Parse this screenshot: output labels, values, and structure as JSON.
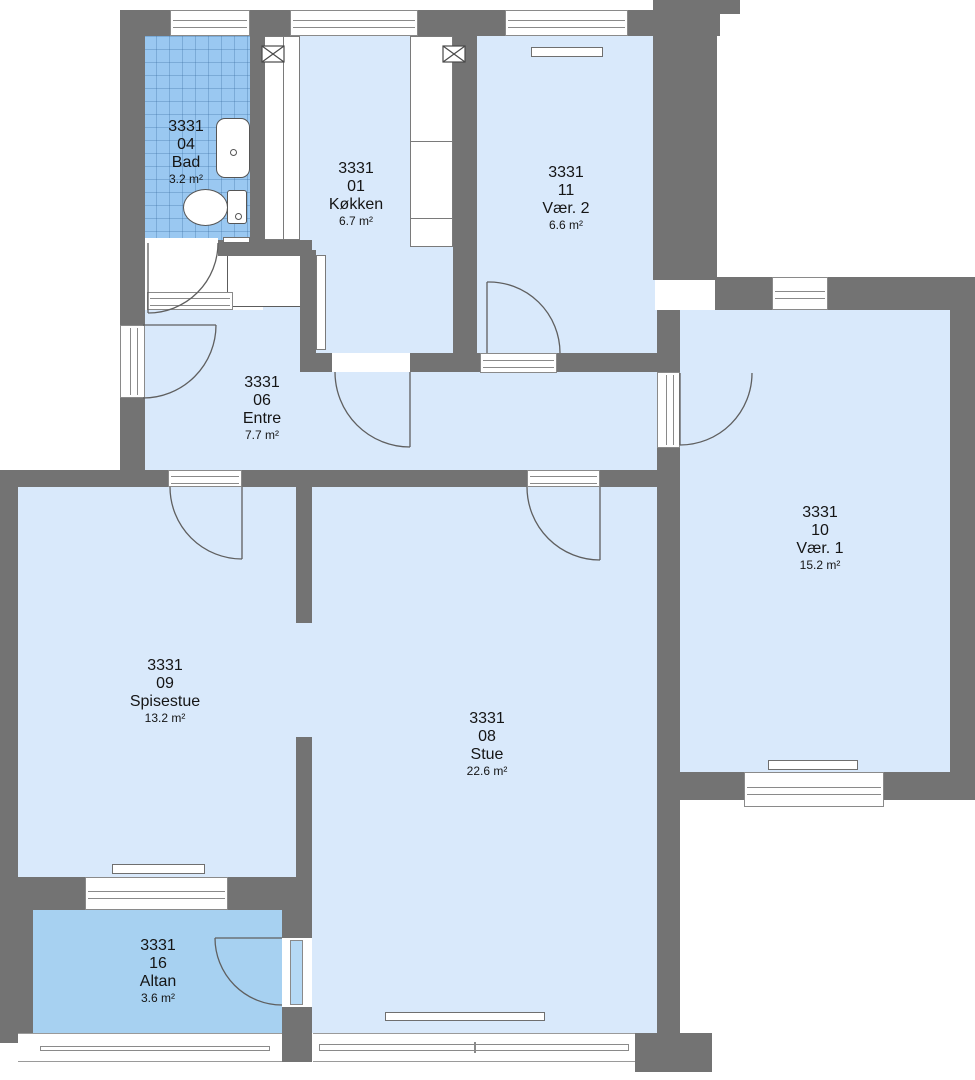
{
  "plan": {
    "building_no": "3331",
    "drawing_type": "apartment-floor-plan",
    "rooms": [
      {
        "building": "3331",
        "number": "04",
        "name": "Bad",
        "area": "3.2 m²"
      },
      {
        "building": "3331",
        "number": "01",
        "name": "Køkken",
        "area": "6.7 m²"
      },
      {
        "building": "3331",
        "number": "11",
        "name": "Vær. 2",
        "area": "6.6 m²"
      },
      {
        "building": "3331",
        "number": "06",
        "name": "Entre",
        "area": "7.7 m²"
      },
      {
        "building": "3331",
        "number": "10",
        "name": "Vær. 1",
        "area": "15.2 m²"
      },
      {
        "building": "3331",
        "number": "09",
        "name": "Spisestue",
        "area": "13.2 m²"
      },
      {
        "building": "3331",
        "number": "08",
        "name": "Stue",
        "area": "22.6 m²"
      },
      {
        "building": "3331",
        "number": "16",
        "name": "Altan",
        "area": "3.6 m²"
      }
    ],
    "colors": {
      "wall": "#737373",
      "floor": "#d9e9fb",
      "balcony_floor": "#a7d1f1",
      "bath_tile": "#9ac8f1",
      "window_frame": "#8a8a8a"
    },
    "icons": {
      "sink": "sink-icon",
      "toilet": "toilet-icon",
      "duct": "crossed-duct-shaft-icon",
      "door": "door-swing-arc"
    }
  }
}
